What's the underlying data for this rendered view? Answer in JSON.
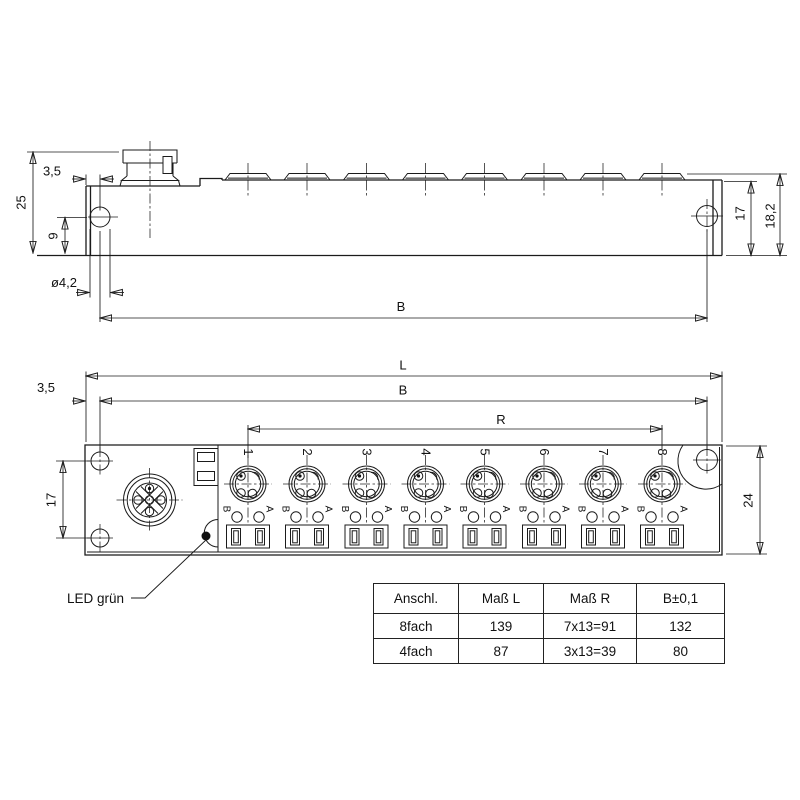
{
  "drawing_title": "M8 distribution box dimensional drawing",
  "colors": {
    "line": "#1b1b1b",
    "background": "#ffffff",
    "text": "#111111"
  },
  "side_view": {
    "dim_total_height": "25",
    "dim_edge_offset": "3,5",
    "dim_hole_center": "9",
    "dim_hole_diameter": "ø4,2",
    "dim_hole_span": "B",
    "dim_body_height": "17",
    "dim_overall_height": "18,2"
  },
  "front_view": {
    "dim_length": "L",
    "dim_hole_span": "B",
    "dim_edge_offset": "3,5",
    "dim_port_span": "R",
    "dim_hole_spacing": "17",
    "dim_height": "24",
    "led_label": "LED grün",
    "led_b": "B",
    "led_a": "A",
    "ports": [
      "1",
      "2",
      "3",
      "4",
      "5",
      "6",
      "7",
      "8"
    ]
  },
  "table": {
    "headers": [
      "Anschl.",
      "Maß L",
      "Maß R",
      "B±0,1"
    ],
    "rows": [
      [
        "8fach",
        "139",
        "7x13=91",
        "132"
      ],
      [
        "4fach",
        "87",
        "3x13=39",
        "80"
      ]
    ]
  }
}
